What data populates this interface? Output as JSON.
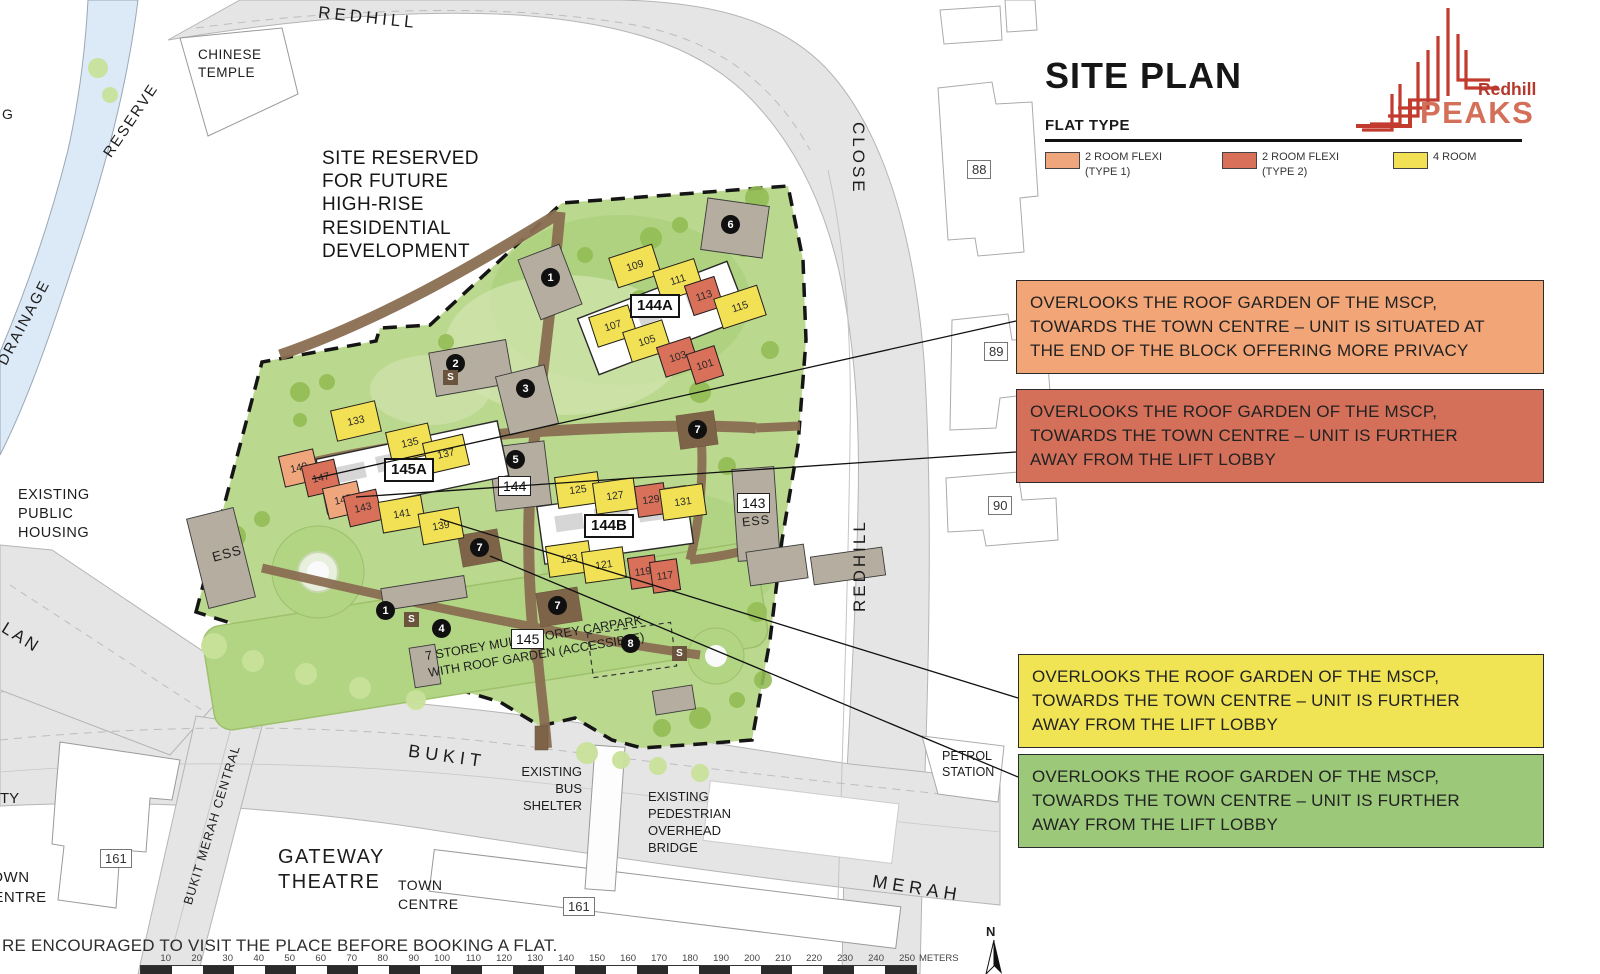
{
  "panel": {
    "title": "SITE PLAN",
    "flat_type_heading": "FLAT TYPE",
    "legend": [
      {
        "label": "2 ROOM FLEXI\n(TYPE 1)",
        "color": "#efa67c"
      },
      {
        "label": "2 ROOM FLEXI\n(TYPE 2)",
        "color": "#d8705a"
      },
      {
        "label": "4 ROOM",
        "color": "#f2e155"
      }
    ],
    "logo": {
      "line1": "Redhill",
      "line2": "PEAKS",
      "accent_color": "#c23b2e",
      "peaks_color": "#d4705a"
    },
    "callouts": [
      {
        "color": "#f2a577",
        "text": "OVERLOOKS THE ROOF GARDEN OF THE MSCP,\nTOWARDS THE TOWN CENTRE – UNIT IS SITUATED AT\nTHE END OF THE BLOCK OFFERING MORE PRIVACY"
      },
      {
        "color": "#d4705a",
        "text": "OVERLOOKS THE ROOF GARDEN OF THE MSCP,\nTOWARDS THE TOWN CENTRE – UNIT IS FURTHER\nAWAY FROM THE LIFT LOBBY"
      },
      {
        "color": "#f0e455",
        "text": "OVERLOOKS THE ROOF GARDEN OF THE MSCP,\nTOWARDS THE TOWN CENTRE – UNIT IS FURTHER\nAWAY FROM THE LIFT LOBBY"
      },
      {
        "color": "#9cc879",
        "text": "OVERLOOKS THE ROOF GARDEN OF THE MSCP,\nTOWARDS THE TOWN CENTRE – UNIT IS FURTHER\nAWAY FROM THE LIFT LOBBY"
      }
    ]
  },
  "map": {
    "roads": {
      "redhill_top": "REDHILL",
      "close": "CLOSE",
      "redhill_right": "REDHILL",
      "bukit": "BUKIT",
      "merah": "MERAH",
      "lan": "LAN",
      "bukit_merah_central": "BUKIT MERAH CENTRAL"
    },
    "water": {
      "reserve": "RESERVE",
      "drainage": "DRAINAGE",
      "partial_g": "G"
    },
    "labels": {
      "chinese_temple": "CHINESE\nTEMPLE",
      "site_reserved": "SITE RESERVED\nFOR FUTURE\nHIGH-RISE\nRESIDENTIAL\nDEVELOPMENT",
      "existing_public_housing": "EXISTING\nPUBLIC\nHOUSING",
      "existing_bus_shelter": "EXISTING\nBUS\nSHELTER",
      "existing_pedestrian_overhead_bridge": "EXISTING\nPEDESTRIAN\nOVERHEAD\nBRIDGE",
      "petrol_station": "PETROL\nSTATION",
      "gateway_theatre": "GATEWAY\nTHEATRE",
      "town_centre_right": "TOWN\nCENTRE",
      "town_centre_left": "TOWN\nCENTRE",
      "partial_ty": "TY",
      "mscp": "7 STOREY MULTI-STOREY CARPARK\nWITH ROOF GARDEN (ACCESSIBLE)",
      "ess_left": "ESS",
      "ess_143": "ESS",
      "compass_n": "N"
    },
    "blocks": {
      "b144A": "144A",
      "b145A": "145A",
      "b144B": "144B",
      "b144": "144",
      "b145": "145",
      "b143": "143",
      "b88": "88",
      "b89": "89",
      "b90": "90",
      "b161_left": "161",
      "b161_bottom": "161"
    },
    "units": [
      {
        "no": "109",
        "type": "4 ROOM"
      },
      {
        "no": "111",
        "type": "4 ROOM"
      },
      {
        "no": "113",
        "type": "2 ROOM FLEXI (TYPE 2)"
      },
      {
        "no": "115",
        "type": "4 ROOM"
      },
      {
        "no": "107",
        "type": "4 ROOM"
      },
      {
        "no": "105",
        "type": "4 ROOM"
      },
      {
        "no": "103",
        "type": "2 ROOM FLEXI (TYPE 2)"
      },
      {
        "no": "101",
        "type": "2 ROOM FLEXI (TYPE 2)"
      },
      {
        "no": "133",
        "type": "4 ROOM"
      },
      {
        "no": "135",
        "type": "4 ROOM"
      },
      {
        "no": "137",
        "type": "4 ROOM"
      },
      {
        "no": "149",
        "type": "2 ROOM FLEXI (TYPE 1)"
      },
      {
        "no": "147",
        "type": "2 ROOM FLEXI (TYPE 2)"
      },
      {
        "no": "145",
        "type": "2 ROOM FLEXI (TYPE 1)"
      },
      {
        "no": "143",
        "type": "2 ROOM FLEXI (TYPE 2)"
      },
      {
        "no": "141",
        "type": "4 ROOM"
      },
      {
        "no": "139",
        "type": "4 ROOM"
      },
      {
        "no": "125",
        "type": "4 ROOM"
      },
      {
        "no": "127",
        "type": "4 ROOM"
      },
      {
        "no": "129",
        "type": "2 ROOM FLEXI (TYPE 2)"
      },
      {
        "no": "131",
        "type": "4 ROOM"
      },
      {
        "no": "123",
        "type": "4 ROOM"
      },
      {
        "no": "121",
        "type": "4 ROOM"
      },
      {
        "no": "119",
        "type": "2 ROOM FLEXI (TYPE 2)"
      },
      {
        "no": "117",
        "type": "2 ROOM FLEXI (TYPE 2)"
      }
    ],
    "markers": [
      "1",
      "2",
      "3",
      "5",
      "6",
      "7",
      "7",
      "7",
      "8",
      "1",
      "4"
    ],
    "s_label": "S",
    "footer": "RE ENCOURAGED TO VISIT THE PLACE BEFORE BOOKING A FLAT.",
    "scale": {
      "values": [
        "10",
        "20",
        "30",
        "40",
        "50",
        "60",
        "70",
        "80",
        "90",
        "100",
        "110",
        "120",
        "130",
        "140",
        "150",
        "160",
        "170",
        "180",
        "190",
        "200",
        "210",
        "220",
        "230",
        "240",
        "250"
      ],
      "unit": "METERS"
    }
  }
}
